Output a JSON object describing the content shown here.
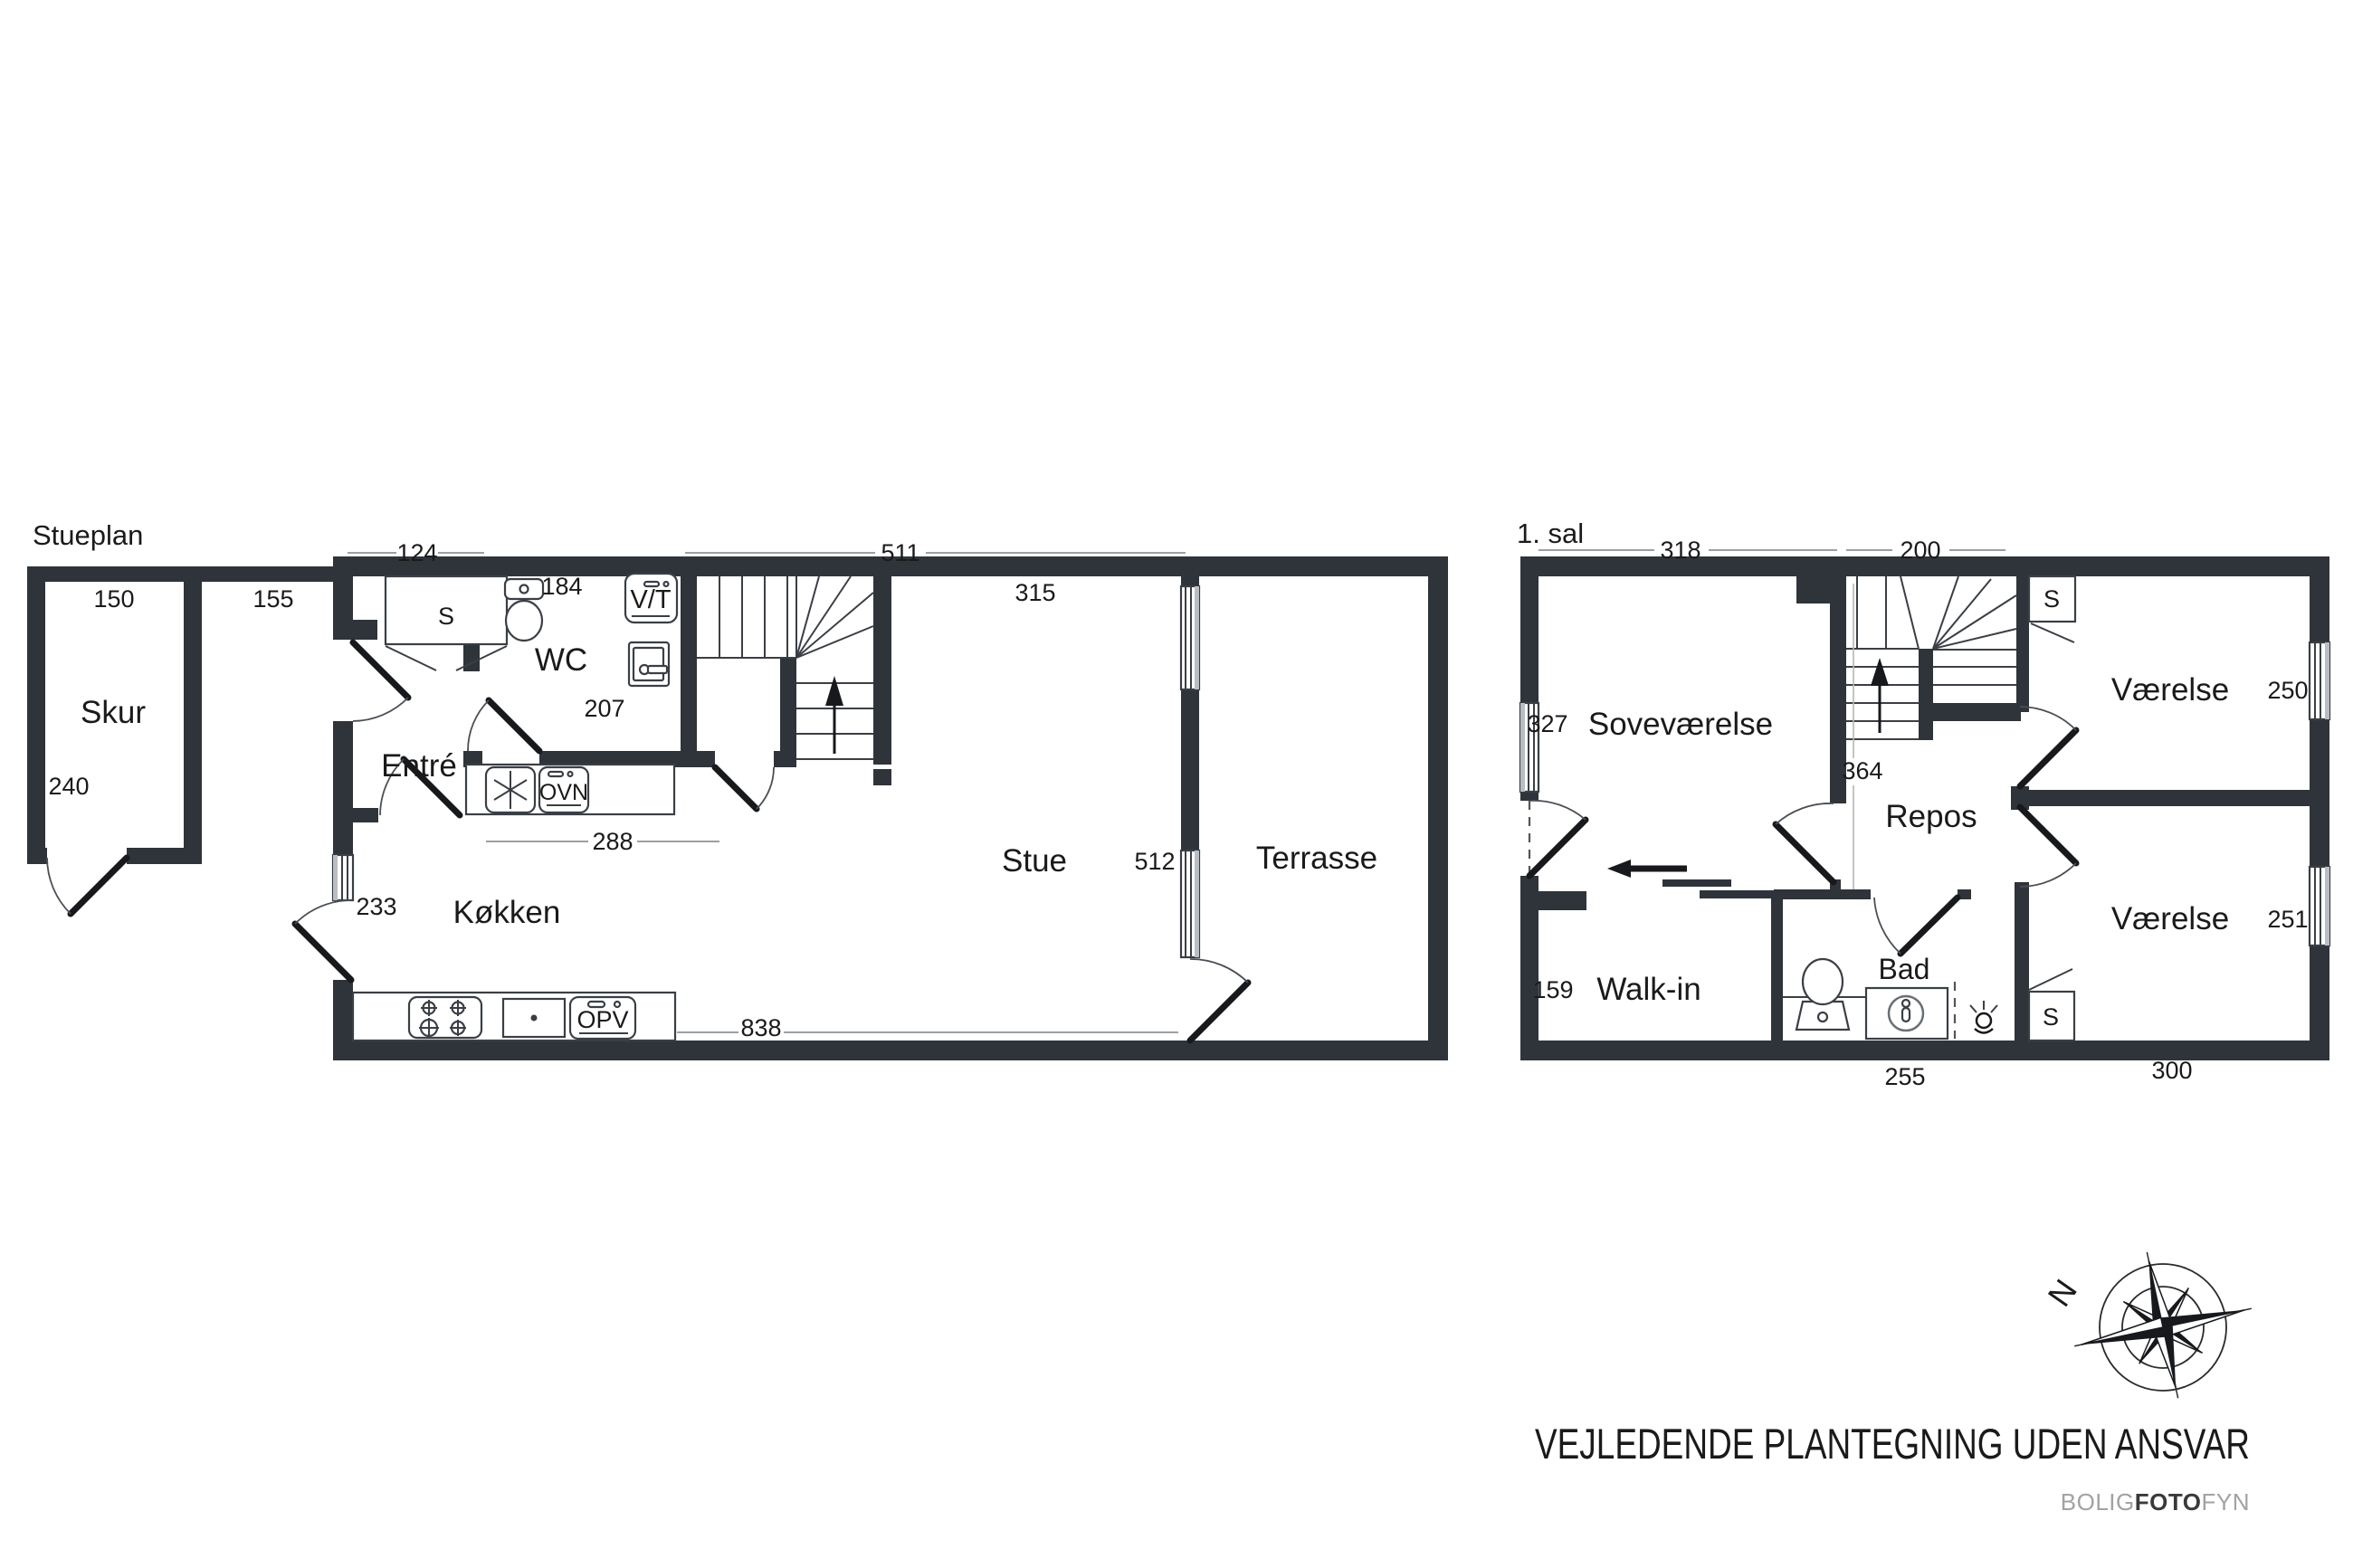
{
  "colors": {
    "wall": "#2f343a",
    "line": "#3a3f45",
    "door": "#17191c",
    "dimline": "#9aa0a6",
    "text": "#1a1a1a",
    "muted": "#a2a2a2",
    "window": "#b9bec4"
  },
  "ground": {
    "title": "Stueplan",
    "rooms": {
      "skur": "Skur",
      "entre": "Entré",
      "wc": "WC",
      "kokken": "Køkken",
      "stue": "Stue",
      "terrasse": "Terrasse"
    },
    "labels": {
      "closet": "S",
      "washer": "V/T",
      "oven": "OVN",
      "dishwasher": "OPV"
    },
    "dims": {
      "d124": "124",
      "d511": "511",
      "d150": "150",
      "d155": "155",
      "d184": "184",
      "d315": "315",
      "d240": "240",
      "d207": "207",
      "d288": "288",
      "d512": "512",
      "d233": "233",
      "d838": "838"
    }
  },
  "first": {
    "title": "1. sal",
    "rooms": {
      "sovevaerelse": "Soveværelse",
      "repos": "Repos",
      "vaerelse_top": "Værelse",
      "vaerelse_bottom": "Værelse",
      "walkin": "Walk-in",
      "bad": "Bad"
    },
    "labels": {
      "closet_top": "S",
      "closet_bottom": "S"
    },
    "dims": {
      "d318": "318",
      "d200": "200",
      "d327": "327",
      "d364": "364",
      "d250": "250",
      "d251": "251",
      "d159": "159",
      "d255": "255",
      "d300": "300"
    }
  },
  "compass": {
    "north": "N"
  },
  "footer": {
    "disclaimer": "VEJLEDENDE PLANTEGNING UDEN ANSVAR",
    "brand": {
      "bolig": "BOLIG",
      "foto": "FOTO",
      "fyn": "FYN"
    }
  }
}
